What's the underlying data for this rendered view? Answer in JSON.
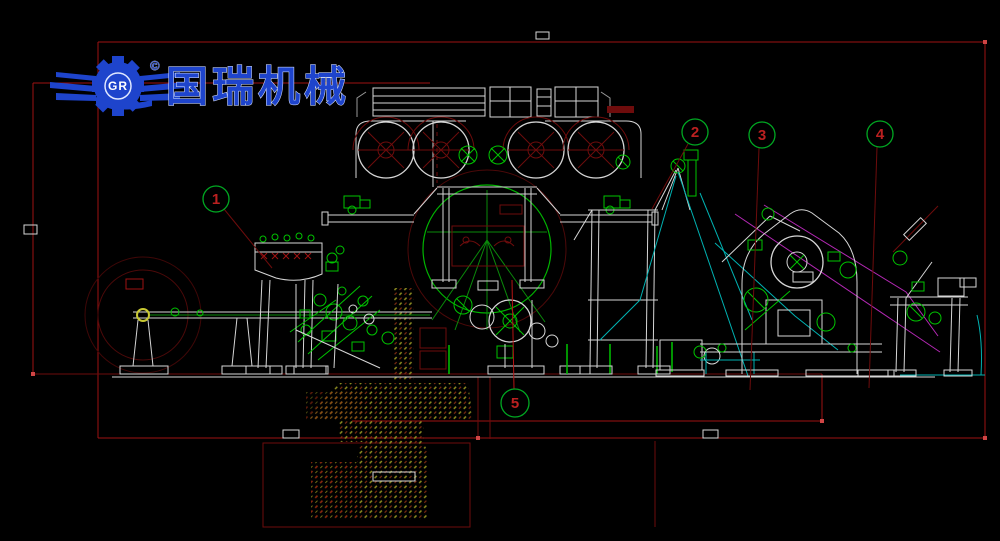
{
  "logo": {
    "company_name": "国瑞机械",
    "monogram": "GR",
    "copyright": "©",
    "primary_color": "#1e44cc"
  },
  "callouts": {
    "items": [
      {
        "label": "1"
      },
      {
        "label": "2"
      },
      {
        "label": "3"
      },
      {
        "label": "4"
      },
      {
        "label": "5"
      }
    ],
    "circle_color": "#00a822",
    "number_color": "#bb2020",
    "leader_color": "#8e1212"
  },
  "colors": {
    "background": "#000000",
    "structure_white": "#d6d6d6",
    "machine_green": "#00c400",
    "border_red": "#9e1212",
    "dark_red_detail": "#6e0c0c",
    "felt_cyan": "#00b2b2",
    "paper_path_magenta": "#b428b4",
    "foundation_hatch_olive": "#8f8f22",
    "foundation_hatch_red": "#7c2c12",
    "logo_blue": "#1e44cc"
  }
}
